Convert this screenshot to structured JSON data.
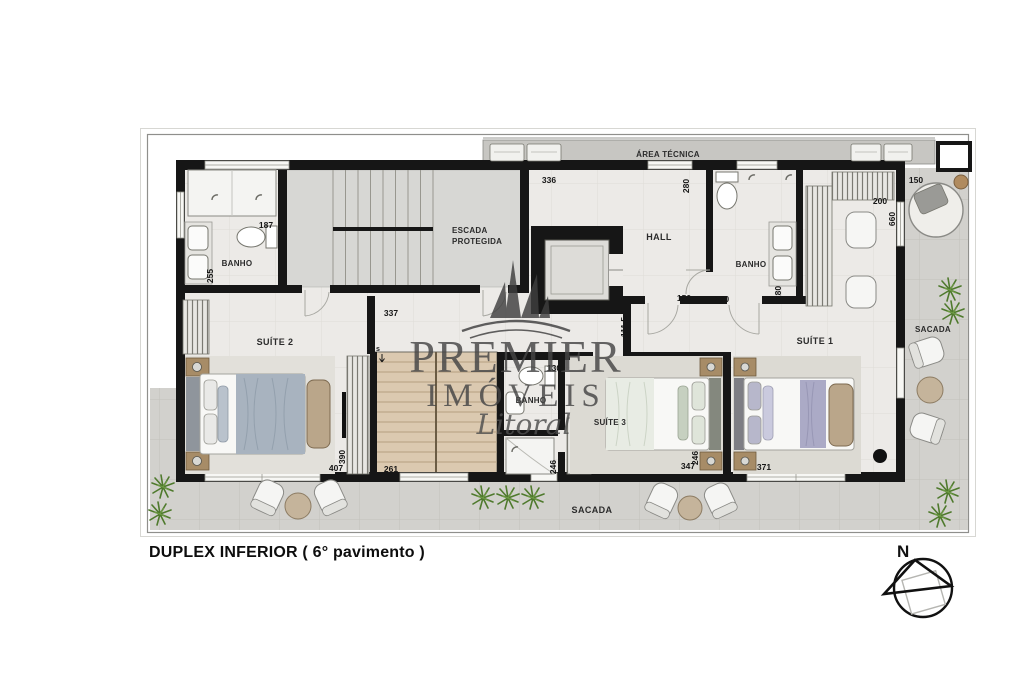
{
  "title": "DUPLEX INFERIOR ( 6° pavimento )",
  "compass_label": "N",
  "watermark": {
    "brand_top": "PREMIER",
    "brand_bottom": "IMÓVEIS",
    "brand_script": "Litoral"
  },
  "rooms": {
    "area_tecnica": "ÁREA TÉCNICA",
    "escada_line1": "ESCADA",
    "escada_line2": "PROTEGIDA",
    "hall": "HALL",
    "banho_left": "BANHO",
    "banho_right": "BANHO",
    "banho_suite3": "BANHO",
    "suite1": "SUÍTE 1",
    "suite2": "SUÍTE 2",
    "suite3": "SUÍTE 3",
    "sacada_right": "SACADA",
    "sacada_bottom": "SACADA",
    "stair_up": "s"
  },
  "dimensions_cm": [
    {
      "value": "187"
    },
    {
      "value": "255"
    },
    {
      "value": "336"
    },
    {
      "value": "337"
    },
    {
      "value": "280"
    },
    {
      "value": "150"
    },
    {
      "value": "200"
    },
    {
      "value": "111,5"
    },
    {
      "value": "280"
    },
    {
      "value": "200"
    },
    {
      "value": "660"
    },
    {
      "value": "150"
    },
    {
      "value": "407"
    },
    {
      "value": "390"
    },
    {
      "value": "261"
    },
    {
      "value": "130"
    },
    {
      "value": "246"
    },
    {
      "value": "347"
    },
    {
      "value": "246"
    },
    {
      "value": "371"
    }
  ],
  "colors": {
    "wall": "#161616",
    "interior_floor": "#eceae7",
    "stair_room": "#d7d7d4",
    "balcony": "#d2d1cd",
    "wood_stair": "#dbc9b0",
    "plant_green": "#4f7a2d",
    "watermark_gray": "#454545"
  }
}
